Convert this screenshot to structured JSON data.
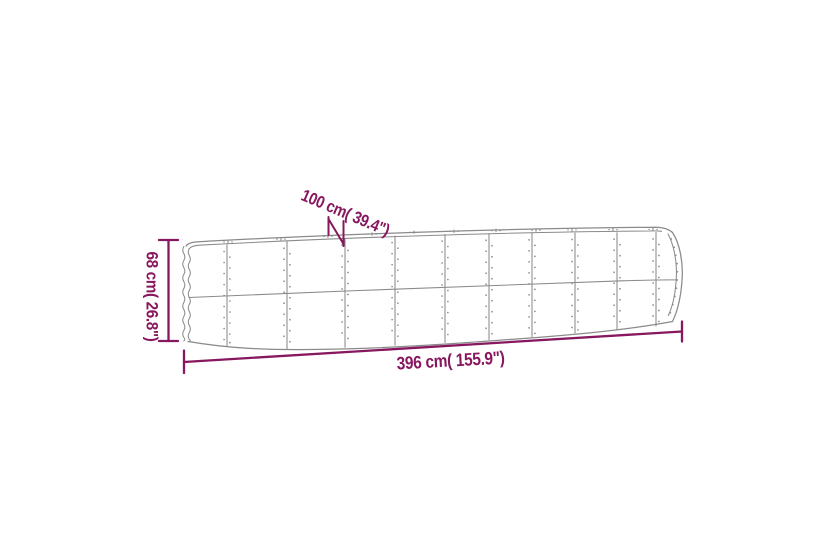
{
  "page": {
    "background": "#ffffff"
  },
  "diagram": {
    "type": "product-dimension-diagram",
    "subject": "oval corrugated-steel raised garden bed, line drawing",
    "labels": {
      "depth": "100 cm( 39.4\")",
      "height": "68 cm( 26.8\")",
      "length": "396 cm( 155.9\")"
    },
    "colors": {
      "dimension_accent": "#87175e",
      "product_outline": "#8a8a8a",
      "background": "#ffffff"
    }
  }
}
